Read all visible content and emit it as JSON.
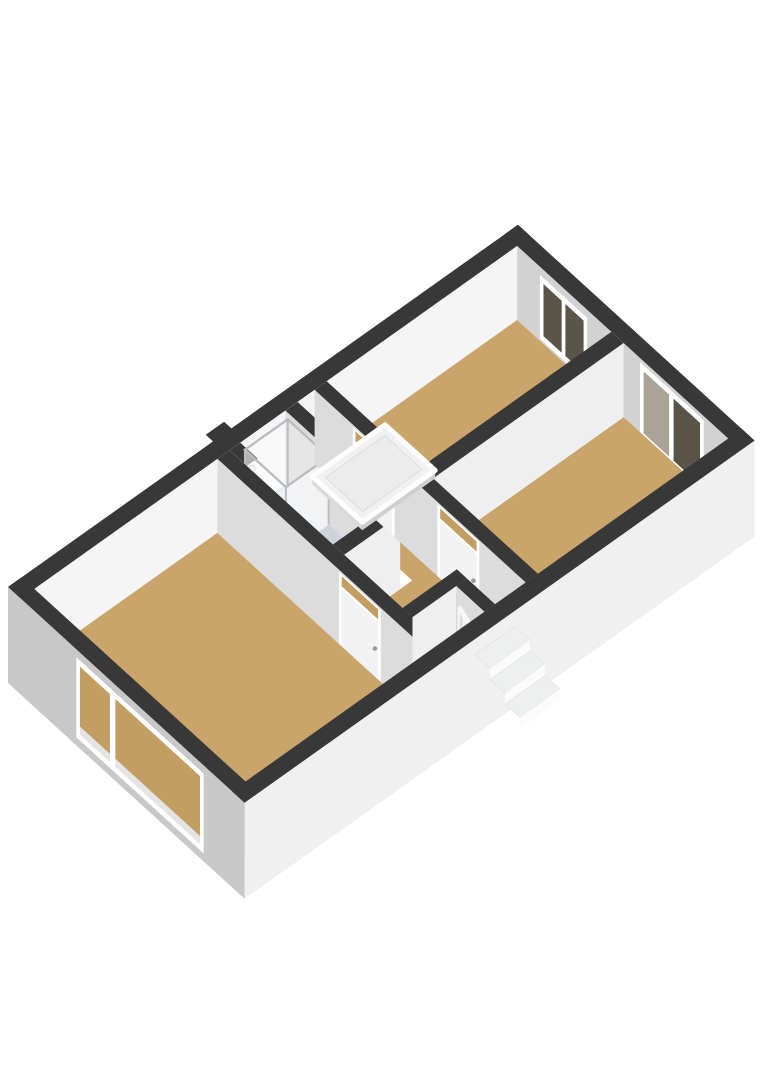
{
  "title": "3D floor plan - upper floor with three bedrooms, bathroom, landing with stairs and attic hatch",
  "colors": {
    "background": "#ffffff",
    "cap": "#383838",
    "floorWood": "#c9a46b",
    "floorBath": "#ccd3db",
    "wallBright": "#f5f5f5",
    "wallLight": "#efefef",
    "wallMid": "#dcdcdc",
    "wallDim": "#d2d2d2",
    "extLight": "#f0f0f0",
    "extDark": "#c8c8c8",
    "frame": "#ffffff",
    "doorLeaf": "#f2f2f2",
    "glassDark": "#5b5549",
    "glassLight": "#a9a496",
    "glassFloor": "#c39e63",
    "slabEdge": "#e4e4e4",
    "chrome": "#b9bdc2",
    "trayWhite": "#e3e7ec",
    "stepTread": "#eef0f0",
    "stepRiser": "#fbfbfb",
    "railWhite": "#f6f6f6",
    "hatchTop": "#f1f1f1",
    "hatchFrame": "#fdfdfd",
    "hatchEdge": "#cfcfcf",
    "handle": "#9a9a9a"
  },
  "scene": [
    {
      "name": "wall-cap-northeast",
      "type": "cap",
      "rect": [
        10.22,
        0,
        10.5,
        5.2
      ]
    },
    {
      "name": "wall-face-northeast-interior",
      "type": "faceX",
      "x": 10.22,
      "y1": 0.28,
      "y2": 4.92,
      "z1": 0,
      "z2": 74,
      "color": "wallDim"
    },
    {
      "name": "window-bedroom-top",
      "type": "window",
      "plane": "x",
      "at": 10.22,
      "a1": 0.78,
      "a2": 1.82,
      "z1": 8,
      "z2": 72,
      "panes": [
        {
          "a1": 0.86,
          "a2": 1.26,
          "fill": "glassDark"
        },
        {
          "a1": 1.34,
          "a2": 1.74,
          "fill": "glassDark"
        }
      ]
    },
    {
      "name": "window-bedroom-right",
      "type": "window",
      "plane": "x",
      "at": 10.22,
      "a1": 2.98,
      "a2": 4.38,
      "z1": 4,
      "z2": 78,
      "panes": [
        {
          "a1": 3.06,
          "a2": 3.62,
          "fill": "glassLight"
        },
        {
          "a1": 3.72,
          "a2": 4.3,
          "fill": "glassDark"
        }
      ]
    },
    {
      "name": "wall-cap-northwest",
      "type": "cap",
      "rect": [
        0,
        0,
        10.5,
        0.28
      ]
    },
    {
      "name": "chimney-cap",
      "type": "cap",
      "rect": [
        4.22,
        -0.16,
        4.6,
        0.04
      ]
    },
    {
      "name": "wall-face-northwest-interior",
      "type": "faceY",
      "y": 0.28,
      "x1": 0.28,
      "x2": 10.22,
      "z1": 0,
      "z2": 74,
      "color": "wallBright"
    },
    {
      "name": "floor-bedroom-large",
      "type": "floor",
      "pts": [
        [
          0.28,
          0.28
        ],
        [
          4.05,
          0.28
        ],
        [
          4.05,
          4.92
        ],
        [
          0.28,
          4.92
        ]
      ],
      "color": "floorWood"
    },
    {
      "name": "floor-bedroom-top",
      "type": "floor",
      "pts": [
        [
          6.3,
          0.28
        ],
        [
          10.22,
          0.28
        ],
        [
          10.22,
          2.35
        ],
        [
          6.3,
          2.35
        ]
      ],
      "color": "floorWood"
    },
    {
      "name": "floor-bedroom-right",
      "type": "floor",
      "pts": [
        [
          6.3,
          2.62
        ],
        [
          10.22,
          2.62
        ],
        [
          10.22,
          4.92
        ],
        [
          6.3,
          4.92
        ]
      ],
      "color": "floorWood"
    },
    {
      "name": "floor-bathroom",
      "type": "floor",
      "pts": [
        [
          4.3,
          0.28
        ],
        [
          5.45,
          0.28
        ],
        [
          5.45,
          2.55
        ],
        [
          4.3,
          2.55
        ]
      ],
      "color": "floorBath"
    },
    {
      "name": "floor-landing",
      "type": "floor",
      "pts": [
        [
          5.7,
          0.28
        ],
        [
          6.05,
          0.28
        ],
        [
          6.05,
          4.92
        ],
        [
          4.3,
          4.92
        ],
        [
          4.3,
          2.8
        ],
        [
          5.7,
          2.8
        ]
      ],
      "color": "floorWood"
    },
    {
      "name": "wall-cap-between-bedrooms",
      "type": "cap",
      "rect": [
        6.3,
        2.35,
        10.22,
        2.62
      ]
    },
    {
      "name": "wall-face-between-bedrooms",
      "type": "faceY",
      "y": 2.62,
      "x1": 6.3,
      "x2": 10.22,
      "z1": 0,
      "z2": 74,
      "color": "wallLight"
    },
    {
      "name": "duct-cap",
      "type": "cap",
      "rect": [
        4.3,
        0.28,
        4.52,
        0.66
      ]
    },
    {
      "name": "duct-face-southeast",
      "type": "faceY",
      "y": 0.66,
      "x1": 4.3,
      "x2": 4.52,
      "z1": 0,
      "z2": 74,
      "color": "wallBright"
    },
    {
      "name": "duct-face-southwest",
      "type": "faceX",
      "x": 4.3,
      "y1": 0.28,
      "y2": 0.66,
      "z1": 0,
      "z2": 74,
      "color": "wallMid"
    },
    {
      "name": "wall-cap-bathroom-east",
      "type": "cap",
      "rect": [
        5.45,
        0.28,
        5.7,
        2.8
      ]
    },
    {
      "name": "wall-face-bathroom-east",
      "type": "faceX",
      "x": 5.45,
      "y1": 0.28,
      "y2": 2.8,
      "z1": 0,
      "z2": 74,
      "color": "wallMid"
    },
    {
      "name": "wall-cap-bathroom-south",
      "type": "cap",
      "rect": [
        4.3,
        2.55,
        5.45,
        2.8
      ]
    },
    {
      "name": "wall-face-bathroom-south",
      "type": "faceY",
      "y": 2.8,
      "x1": 4.3,
      "x2": 5.45,
      "z1": 0,
      "z2": 74,
      "color": "wallLight"
    },
    {
      "name": "shower-enclosure",
      "type": "shower",
      "rect": [
        4.56,
        0.34,
        5.44,
        1.24
      ]
    },
    {
      "name": "wall-cap-bedroom-partition-west",
      "type": "cap",
      "rect": [
        6.05,
        0.28,
        6.3,
        4.92
      ]
    },
    {
      "name": "wall-face-bedroom-partition-west",
      "type": "faceX",
      "x": 6.05,
      "y1": 0.28,
      "y2": 4.92,
      "z1": 0,
      "z2": 74,
      "color": "wallMid"
    },
    {
      "name": "door-bedroom-top",
      "type": "door",
      "at": 6.05,
      "a1": 1.12,
      "a2": 2.04
    },
    {
      "name": "door-bedroom-right",
      "type": "door",
      "at": 6.05,
      "a1": 2.98,
      "a2": 3.9
    },
    {
      "name": "attic-hatch",
      "type": "hatch",
      "rect": [
        5.0,
        1.35,
        6.5,
        2.45
      ]
    },
    {
      "name": "wall-cap-bedroom-large-east",
      "type": "cap",
      "rect": [
        4.05,
        0.28,
        4.3,
        4.92
      ]
    },
    {
      "name": "wall-face-bedroom-large-east",
      "type": "faceX",
      "x": 4.05,
      "y1": 0.28,
      "y2": 4.92,
      "z1": 0,
      "z2": 74,
      "color": "wallMid"
    },
    {
      "name": "door-bedroom-large",
      "type": "door",
      "at": 4.05,
      "a1": 2.95,
      "a2": 3.87
    },
    {
      "name": "closet",
      "type": "closet"
    },
    {
      "name": "stair-railing",
      "type": "railing"
    },
    {
      "name": "wall-cap-southwest",
      "type": "cap",
      "rect": [
        0,
        0,
        0.28,
        5.2
      ]
    },
    {
      "name": "wall-face-southwest-exterior",
      "type": "faceX",
      "x": 0,
      "y1": 0,
      "y2": 5.2,
      "z1": 0,
      "z2": 96,
      "color": "extDark"
    },
    {
      "name": "window-bedroom-large",
      "type": "window",
      "plane": "x",
      "at": 0,
      "a1": 1.5,
      "a2": 4.3,
      "z1": 8,
      "z2": 88,
      "panes": [
        {
          "a1": 1.58,
          "a2": 2.24,
          "fill": "glassFloor",
          "split": 74,
          "lower": "slabEdge"
        },
        {
          "a1": 2.36,
          "a2": 4.22,
          "fill": "glassFloor",
          "split": 74,
          "lower": "slabEdge"
        }
      ]
    },
    {
      "name": "wall-cap-southeast",
      "type": "cap",
      "rect": [
        0,
        4.92,
        10.5,
        5.2
      ]
    },
    {
      "name": "wall-face-southeast-exterior",
      "type": "faceY",
      "y": 5.2,
      "x1": 0,
      "x2": 10.5,
      "z1": 0,
      "z2": 96,
      "color": "extLight"
    },
    {
      "name": "stairs-exterior",
      "type": "steps"
    }
  ]
}
